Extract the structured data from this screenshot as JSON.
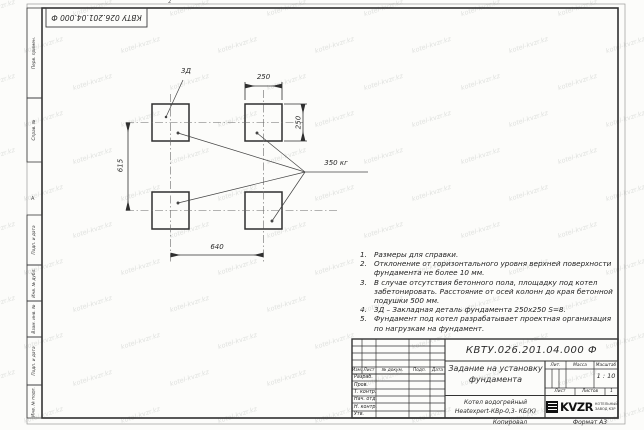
{
  "frame": {
    "designation_flipped": "КВТУ 026.201.04.000 Ф",
    "zone_top": "2",
    "zone_left": "А",
    "margin_labels": [
      "Перв. примен.",
      "Справ. №",
      "Подп. и дата",
      "Инв. № дубл.",
      "Взам. инв. №",
      "Подп. и дата",
      "Инв. № подл."
    ]
  },
  "watermark": {
    "text": "kotel-kvzr.kz"
  },
  "drawing": {
    "detail_label": "3Д",
    "load_label": "350 кг",
    "dim_top": "250",
    "dim_right": "250",
    "dim_left": "615",
    "dim_bottom": "640"
  },
  "notes": [
    {
      "num": "1.",
      "text": "Размеры для справки."
    },
    {
      "num": "2.",
      "text": "Отклонение от горизонтального уровня верхней поверхности фундамента не более 10 мм."
    },
    {
      "num": "3.",
      "text": "В случае отсутствия бетонного пола, площадку под котел забетонировать. Расстояние от осей колонн до края бетонной подушки 500 мм."
    },
    {
      "num": "4.",
      "text": "3Д – Закладная деталь фундамента 250х250 S=8."
    },
    {
      "num": "5.",
      "text": "Фундамент под котел разрабатывает проектная организация по нагрузкам на фундамент."
    }
  ],
  "title_block": {
    "designation": "КВТУ.026.201.04.000 Ф",
    "doc_title_line1": "Задание на установку",
    "doc_title_line2": "фундамента",
    "col_izm": "Изм.",
    "col_list": "Лист",
    "col_docnum": "№ докум.",
    "col_podp": "Подп.",
    "col_data": "Дата",
    "rows": [
      "Разраб.",
      "Пров.",
      "Т. контр.",
      "Нач. отд.",
      "Н. контр.",
      "Утв."
    ],
    "lit_label": "Лит.",
    "mass_label": "Масса",
    "scale_label": "Масштаб",
    "scale_value": "1 : 10",
    "sheet_label": "Лист",
    "sheets_label": "Листов",
    "sheets_value": "1",
    "product_line1": "Котел водогрейный",
    "product_line2": "Heatexpert-КВр-0,3- КБ(К)",
    "logo_text": "KVZR",
    "logo_sub1": "КОТЕЛЬНЫЙ",
    "logo_sub2": "ЗАВОД КЗР",
    "footer_copy": "Копировал",
    "footer_format": "Формат А3"
  }
}
